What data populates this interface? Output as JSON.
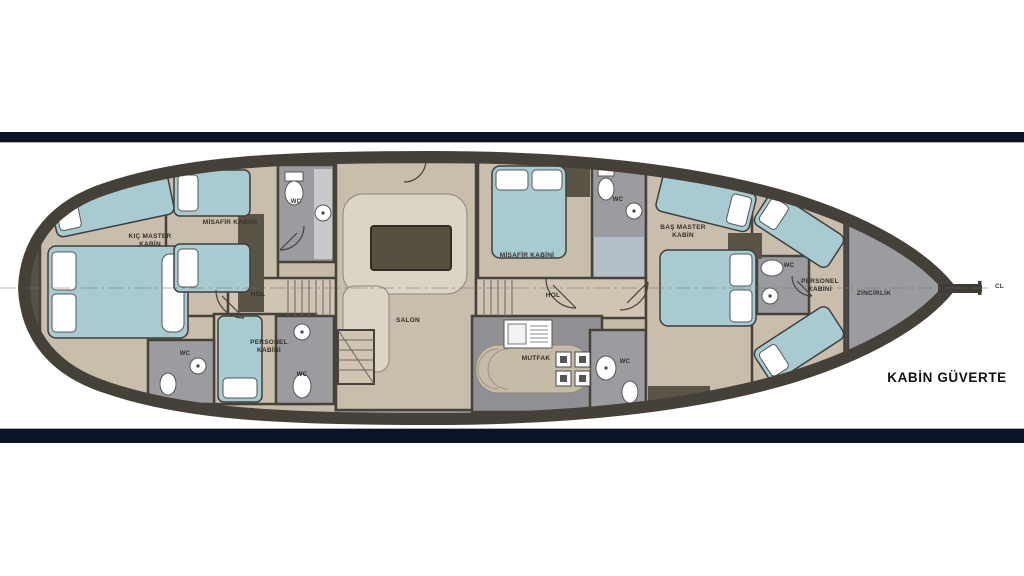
{
  "deck_plan": {
    "title": "KABİN GÜVERTE",
    "centerline": "CL",
    "rooms": {
      "kic_master": "KIÇ MASTER\nKABİN",
      "misafir_left": "MİSAFİR KABİNİ",
      "wc": "WC",
      "hol": "HOL",
      "personel": "PERSONEL\nKABİNİ",
      "salon": "SALON",
      "misafir_right": "MİSAFİR KABİNİ",
      "mutfak": "MUTFAK",
      "bas_master": "BAŞ MASTER\nKABİN",
      "zincirlik": "ZİNCİRLİK"
    },
    "colors": {
      "banner_navy": "#0b1426",
      "hull_outline": "#454139",
      "floor_beige": "#c9beab",
      "corridor_beige": "#cfc5b2",
      "deck_gray": "#97989b",
      "bed_teal": "#a7cbd1",
      "wood_dark": "#5a5447",
      "table_dark": "#57503e",
      "shower_blue": "#b4bec6"
    }
  }
}
